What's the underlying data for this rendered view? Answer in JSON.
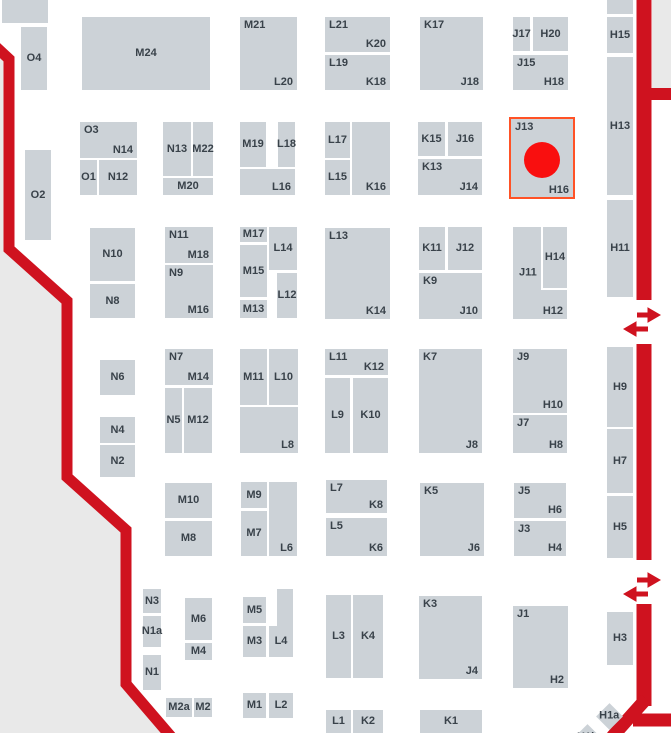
{
  "map_title": "exhibition-hall-floor-plan",
  "colors": {
    "booth_fill": "#ccd2d7",
    "outside_fill": "#e9e9e9",
    "boundary_red": "#cf121f",
    "highlight_outline": "#ff5226",
    "marker_red": "#f90f0f",
    "label_text": "#39424a",
    "background": "#ffffff"
  },
  "highlight": {
    "booth": "J13-H16",
    "frame": {
      "x": 509,
      "y": 117,
      "w": 66,
      "h": 82
    },
    "marker": {
      "cx": 542,
      "cy": 160,
      "r": 18
    }
  },
  "booths": [
    {
      "id": "block-a",
      "x": 2,
      "y": 0,
      "w": 46,
      "h": 23,
      "l": []
    },
    {
      "id": "O4",
      "x": 21,
      "y": 27,
      "w": 26,
      "h": 63,
      "l": [
        [
          "O4",
          "c"
        ]
      ]
    },
    {
      "id": "M24",
      "x": 82,
      "y": 17,
      "w": 128,
      "h": 73,
      "l": [
        [
          "M24",
          "c"
        ]
      ]
    },
    {
      "id": "M21-L20",
      "x": 240,
      "y": 17,
      "w": 57,
      "h": 73,
      "l": [
        [
          "M21",
          "tl"
        ],
        [
          "L20",
          "br"
        ]
      ]
    },
    {
      "id": "L21-K20",
      "x": 325,
      "y": 17,
      "w": 65,
      "h": 35,
      "l": [
        [
          "L21",
          "tl"
        ],
        [
          "K20",
          "br"
        ]
      ]
    },
    {
      "id": "L19-K18",
      "x": 325,
      "y": 55,
      "w": 65,
      "h": 35,
      "l": [
        [
          "L19",
          "tl"
        ],
        [
          "K18",
          "br"
        ]
      ]
    },
    {
      "id": "K17-J18",
      "x": 420,
      "y": 17,
      "w": 63,
      "h": 73,
      "l": [
        [
          "K17",
          "tl"
        ],
        [
          "J18",
          "br"
        ]
      ]
    },
    {
      "id": "J17",
      "x": 513,
      "y": 17,
      "w": 17,
      "h": 34,
      "l": [
        [
          "J17",
          "c"
        ]
      ]
    },
    {
      "id": "H20",
      "x": 533,
      "y": 17,
      "w": 35,
      "h": 34,
      "l": [
        [
          "H20",
          "c"
        ]
      ]
    },
    {
      "id": "J15-H18",
      "x": 513,
      "y": 55,
      "w": 55,
      "h": 35,
      "l": [
        [
          "J15",
          "tl"
        ],
        [
          "H18",
          "br"
        ]
      ]
    },
    {
      "id": "block-b",
      "x": 607,
      "y": 0,
      "w": 26,
      "h": 14,
      "l": []
    },
    {
      "id": "H15",
      "x": 607,
      "y": 17,
      "w": 26,
      "h": 36,
      "l": [
        [
          "H15",
          "c"
        ]
      ]
    },
    {
      "id": "H13",
      "x": 607,
      "y": 57,
      "w": 26,
      "h": 138,
      "l": [
        [
          "H13",
          "c"
        ]
      ]
    },
    {
      "id": "H11",
      "x": 607,
      "y": 200,
      "w": 26,
      "h": 97,
      "l": [
        [
          "H11",
          "c"
        ]
      ]
    },
    {
      "id": "O2",
      "x": 25,
      "y": 150,
      "w": 26,
      "h": 90,
      "l": [
        [
          "O2",
          "c"
        ]
      ]
    },
    {
      "id": "O3-N14",
      "x": 80,
      "y": 122,
      "w": 57,
      "h": 36,
      "l": [
        [
          "O3",
          "tl"
        ],
        [
          "N14",
          "br"
        ]
      ]
    },
    {
      "id": "O1",
      "x": 80,
      "y": 160,
      "w": 17,
      "h": 35,
      "l": [
        [
          "O1",
          "c"
        ]
      ]
    },
    {
      "id": "N12",
      "x": 99,
      "y": 160,
      "w": 38,
      "h": 35,
      "l": [
        [
          "N12",
          "c"
        ]
      ]
    },
    {
      "id": "N13",
      "x": 163,
      "y": 122,
      "w": 28,
      "h": 54,
      "l": [
        [
          "N13",
          "c"
        ]
      ]
    },
    {
      "id": "M22",
      "x": 193,
      "y": 122,
      "w": 20,
      "h": 54,
      "l": [
        [
          "M22",
          "c"
        ]
      ]
    },
    {
      "id": "M20",
      "x": 163,
      "y": 178,
      "w": 50,
      "h": 17,
      "l": [
        [
          "M20",
          "c"
        ]
      ]
    },
    {
      "id": "M19",
      "x": 240,
      "y": 122,
      "w": 26,
      "h": 45,
      "l": [
        [
          "M19",
          "c"
        ]
      ]
    },
    {
      "id": "L18",
      "x": 278,
      "y": 122,
      "w": 17,
      "h": 45,
      "l": [
        [
          "L18",
          "c"
        ]
      ]
    },
    {
      "id": "L16",
      "x": 240,
      "y": 169,
      "w": 55,
      "h": 26,
      "l": [
        [
          "L16",
          "br"
        ]
      ]
    },
    {
      "id": "L17",
      "x": 325,
      "y": 122,
      "w": 25,
      "h": 36,
      "l": [
        [
          "L17",
          "c"
        ]
      ]
    },
    {
      "id": "L15",
      "x": 325,
      "y": 160,
      "w": 25,
      "h": 35,
      "l": [
        [
          "L15",
          "c"
        ]
      ]
    },
    {
      "id": "K16",
      "x": 352,
      "y": 122,
      "w": 38,
      "h": 73,
      "l": [
        [
          "K16",
          "br"
        ]
      ]
    },
    {
      "id": "K15",
      "x": 418,
      "y": 122,
      "w": 27,
      "h": 34,
      "l": [
        [
          "K15",
          "c"
        ]
      ]
    },
    {
      "id": "J16",
      "x": 448,
      "y": 122,
      "w": 34,
      "h": 34,
      "l": [
        [
          "J16",
          "c"
        ]
      ]
    },
    {
      "id": "K13-J14",
      "x": 418,
      "y": 159,
      "w": 64,
      "h": 36,
      "l": [
        [
          "K13",
          "tl"
        ],
        [
          "J14",
          "br"
        ]
      ]
    },
    {
      "id": "J13-H16",
      "x": 511,
      "y": 119,
      "w": 62,
      "h": 79,
      "l": [
        [
          "J13",
          "tl"
        ],
        [
          "H16",
          "br"
        ]
      ],
      "hl": true
    },
    {
      "id": "N10",
      "x": 90,
      "y": 228,
      "w": 45,
      "h": 53,
      "l": [
        [
          "N10",
          "c"
        ]
      ]
    },
    {
      "id": "N8",
      "x": 90,
      "y": 284,
      "w": 45,
      "h": 34,
      "l": [
        [
          "N8",
          "c"
        ]
      ]
    },
    {
      "id": "N11-M18",
      "x": 165,
      "y": 227,
      "w": 48,
      "h": 36,
      "l": [
        [
          "N11",
          "tl"
        ],
        [
          "M18",
          "br"
        ]
      ]
    },
    {
      "id": "N9-M16",
      "x": 165,
      "y": 265,
      "w": 48,
      "h": 53,
      "l": [
        [
          "N9",
          "tl"
        ],
        [
          "M16",
          "br"
        ]
      ]
    },
    {
      "id": "M17",
      "x": 240,
      "y": 227,
      "w": 27,
      "h": 15,
      "l": [
        [
          "M17",
          "c"
        ]
      ]
    },
    {
      "id": "L14",
      "x": 269,
      "y": 227,
      "w": 28,
      "h": 43,
      "l": [
        [
          "L14",
          "c"
        ]
      ]
    },
    {
      "id": "M15",
      "x": 240,
      "y": 245,
      "w": 27,
      "h": 52,
      "l": [
        [
          "M15",
          "c"
        ]
      ]
    },
    {
      "id": "M13",
      "x": 240,
      "y": 300,
      "w": 27,
      "h": 18,
      "l": [
        [
          "M13",
          "c"
        ]
      ]
    },
    {
      "id": "L12",
      "x": 277,
      "y": 273,
      "w": 20,
      "h": 45,
      "l": [
        [
          "L12",
          "c"
        ]
      ]
    },
    {
      "id": "L13-K14",
      "x": 325,
      "y": 228,
      "w": 65,
      "h": 91,
      "l": [
        [
          "L13",
          "tl"
        ],
        [
          "K14",
          "br"
        ]
      ]
    },
    {
      "id": "K11",
      "x": 419,
      "y": 227,
      "w": 26,
      "h": 43,
      "l": [
        [
          "K11",
          "c"
        ]
      ]
    },
    {
      "id": "J12",
      "x": 448,
      "y": 227,
      "w": 34,
      "h": 43,
      "l": [
        [
          "J12",
          "c"
        ]
      ]
    },
    {
      "id": "K9-J10",
      "x": 419,
      "y": 273,
      "w": 63,
      "h": 46,
      "l": [
        [
          "K9",
          "tl"
        ],
        [
          "J10",
          "br"
        ]
      ]
    },
    {
      "id": "J11-H12",
      "x": 513,
      "y": 227,
      "w": 54,
      "h": 92,
      "l": [
        [
          "J11",
          "ml"
        ],
        [
          "H12",
          "br"
        ]
      ]
    },
    {
      "id": "H14",
      "x": 541,
      "y": 227,
      "w": 26,
      "h": 63,
      "l": [
        [
          "H14",
          "c"
        ]
      ],
      "wb": true
    },
    {
      "id": "N6",
      "x": 100,
      "y": 360,
      "w": 35,
      "h": 35,
      "l": [
        [
          "N6",
          "c"
        ]
      ]
    },
    {
      "id": "N4",
      "x": 100,
      "y": 417,
      "w": 35,
      "h": 26,
      "l": [
        [
          "N4",
          "c"
        ]
      ]
    },
    {
      "id": "N2",
      "x": 100,
      "y": 445,
      "w": 35,
      "h": 32,
      "l": [
        [
          "N2",
          "c"
        ]
      ]
    },
    {
      "id": "N7-M14",
      "x": 165,
      "y": 349,
      "w": 48,
      "h": 36,
      "l": [
        [
          "N7",
          "tl"
        ],
        [
          "M14",
          "br"
        ]
      ]
    },
    {
      "id": "N5",
      "x": 165,
      "y": 388,
      "w": 17,
      "h": 65,
      "l": [
        [
          "N5",
          "c"
        ]
      ]
    },
    {
      "id": "M12",
      "x": 184,
      "y": 388,
      "w": 28,
      "h": 65,
      "l": [
        [
          "M12",
          "c"
        ]
      ]
    },
    {
      "id": "M11",
      "x": 240,
      "y": 349,
      "w": 27,
      "h": 56,
      "l": [
        [
          "M11",
          "c"
        ]
      ]
    },
    {
      "id": "L10",
      "x": 269,
      "y": 349,
      "w": 29,
      "h": 56,
      "l": [
        [
          "L10",
          "c"
        ]
      ]
    },
    {
      "id": "L8",
      "x": 240,
      "y": 407,
      "w": 58,
      "h": 46,
      "l": [
        [
          "L8",
          "br"
        ]
      ]
    },
    {
      "id": "L11-K12",
      "x": 325,
      "y": 349,
      "w": 63,
      "h": 26,
      "l": [
        [
          "L11",
          "tl"
        ],
        [
          "K12",
          "br"
        ]
      ]
    },
    {
      "id": "L9",
      "x": 325,
      "y": 378,
      "w": 25,
      "h": 75,
      "l": [
        [
          "L9",
          "c"
        ]
      ]
    },
    {
      "id": "K10",
      "x": 353,
      "y": 378,
      "w": 35,
      "h": 75,
      "l": [
        [
          "K10",
          "c"
        ]
      ]
    },
    {
      "id": "K7-J8",
      "x": 419,
      "y": 349,
      "w": 63,
      "h": 104,
      "l": [
        [
          "K7",
          "tl"
        ],
        [
          "J8",
          "br"
        ]
      ]
    },
    {
      "id": "J9-H10",
      "x": 513,
      "y": 349,
      "w": 54,
      "h": 64,
      "l": [
        [
          "J9",
          "tl"
        ],
        [
          "H10",
          "br"
        ]
      ]
    },
    {
      "id": "J7-H8",
      "x": 513,
      "y": 415,
      "w": 54,
      "h": 38,
      "l": [
        [
          "J7",
          "tl"
        ],
        [
          "H8",
          "br"
        ]
      ]
    },
    {
      "id": "H9",
      "x": 607,
      "y": 347,
      "w": 26,
      "h": 80,
      "l": [
        [
          "H9",
          "c"
        ]
      ]
    },
    {
      "id": "H7",
      "x": 607,
      "y": 429,
      "w": 26,
      "h": 64,
      "l": [
        [
          "H7",
          "c"
        ]
      ]
    },
    {
      "id": "H5",
      "x": 607,
      "y": 496,
      "w": 26,
      "h": 62,
      "l": [
        [
          "H5",
          "c"
        ]
      ]
    },
    {
      "id": "M10",
      "x": 165,
      "y": 483,
      "w": 47,
      "h": 35,
      "l": [
        [
          "M10",
          "c"
        ]
      ]
    },
    {
      "id": "M8",
      "x": 165,
      "y": 521,
      "w": 47,
      "h": 35,
      "l": [
        [
          "M8",
          "c"
        ]
      ]
    },
    {
      "id": "M9",
      "x": 241,
      "y": 482,
      "w": 26,
      "h": 26,
      "l": [
        [
          "M9",
          "c"
        ]
      ]
    },
    {
      "id": "M7",
      "x": 241,
      "y": 511,
      "w": 26,
      "h": 45,
      "l": [
        [
          "M7",
          "c"
        ]
      ]
    },
    {
      "id": "L6",
      "x": 269,
      "y": 482,
      "w": 28,
      "h": 74,
      "l": [
        [
          "L6",
          "br"
        ]
      ]
    },
    {
      "id": "L7-K8",
      "x": 326,
      "y": 480,
      "w": 61,
      "h": 33,
      "l": [
        [
          "L7",
          "tl"
        ],
        [
          "K8",
          "br"
        ]
      ]
    },
    {
      "id": "L5-K6",
      "x": 326,
      "y": 518,
      "w": 61,
      "h": 38,
      "l": [
        [
          "L5",
          "tl"
        ],
        [
          "K6",
          "br"
        ]
      ]
    },
    {
      "id": "K5-J6",
      "x": 420,
      "y": 483,
      "w": 64,
      "h": 73,
      "l": [
        [
          "K5",
          "tl"
        ],
        [
          "J6",
          "br"
        ]
      ]
    },
    {
      "id": "J5-H6",
      "x": 514,
      "y": 483,
      "w": 52,
      "h": 35,
      "l": [
        [
          "J5",
          "tl"
        ],
        [
          "H6",
          "br"
        ]
      ]
    },
    {
      "id": "J3-H4",
      "x": 514,
      "y": 521,
      "w": 52,
      "h": 35,
      "l": [
        [
          "J3",
          "tl"
        ],
        [
          "H4",
          "br"
        ]
      ]
    },
    {
      "id": "N3",
      "x": 143,
      "y": 589,
      "w": 18,
      "h": 24,
      "l": [
        [
          "N3",
          "c"
        ]
      ]
    },
    {
      "id": "N1a",
      "x": 143,
      "y": 616,
      "w": 18,
      "h": 31,
      "l": [
        [
          "N1a",
          "c"
        ]
      ]
    },
    {
      "id": "N1",
      "x": 143,
      "y": 655,
      "w": 18,
      "h": 35,
      "l": [
        [
          "N1",
          "c"
        ]
      ]
    },
    {
      "id": "M6",
      "x": 185,
      "y": 598,
      "w": 27,
      "h": 42,
      "l": [
        [
          "M6",
          "c"
        ]
      ]
    },
    {
      "id": "M4",
      "x": 185,
      "y": 643,
      "w": 27,
      "h": 17,
      "l": [
        [
          "M4",
          "c"
        ]
      ]
    },
    {
      "id": "M5",
      "x": 243,
      "y": 597,
      "w": 23,
      "h": 26,
      "l": [
        [
          "M5",
          "c"
        ]
      ]
    },
    {
      "id": "M3",
      "x": 243,
      "y": 626,
      "w": 23,
      "h": 31,
      "l": [
        [
          "M3",
          "c"
        ]
      ]
    },
    {
      "id": "L4-upper",
      "x": 277,
      "y": 589,
      "w": 16,
      "h": 37,
      "l": []
    },
    {
      "id": "L4",
      "x": 269,
      "y": 626,
      "w": 24,
      "h": 31,
      "l": [
        [
          "L4",
          "c"
        ]
      ]
    },
    {
      "id": "L3",
      "x": 326,
      "y": 595,
      "w": 25,
      "h": 83,
      "l": [
        [
          "L3",
          "c"
        ]
      ]
    },
    {
      "id": "K4",
      "x": 353,
      "y": 595,
      "w": 30,
      "h": 83,
      "l": [
        [
          "K4",
          "c"
        ]
      ]
    },
    {
      "id": "K3-J4",
      "x": 419,
      "y": 596,
      "w": 63,
      "h": 83,
      "l": [
        [
          "K3",
          "tl"
        ],
        [
          "J4",
          "br"
        ]
      ]
    },
    {
      "id": "J1-H2",
      "x": 513,
      "y": 606,
      "w": 55,
      "h": 82,
      "l": [
        [
          "J1",
          "tl"
        ],
        [
          "H2",
          "br"
        ]
      ]
    },
    {
      "id": "H3",
      "x": 607,
      "y": 612,
      "w": 26,
      "h": 53,
      "l": [
        [
          "H3",
          "c"
        ]
      ]
    },
    {
      "id": "M2a",
      "x": 166,
      "y": 698,
      "w": 26,
      "h": 19,
      "l": [
        [
          "M2a",
          "c"
        ]
      ]
    },
    {
      "id": "M2",
      "x": 194,
      "y": 698,
      "w": 18,
      "h": 19,
      "l": [
        [
          "M2",
          "c"
        ]
      ]
    },
    {
      "id": "M1",
      "x": 243,
      "y": 693,
      "w": 23,
      "h": 25,
      "l": [
        [
          "M1",
          "c"
        ]
      ]
    },
    {
      "id": "L2",
      "x": 269,
      "y": 693,
      "w": 24,
      "h": 25,
      "l": [
        [
          "L2",
          "c"
        ]
      ]
    },
    {
      "id": "L1",
      "x": 326,
      "y": 710,
      "w": 25,
      "h": 23,
      "l": [
        [
          "L1",
          "c"
        ]
      ]
    },
    {
      "id": "K2",
      "x": 353,
      "y": 710,
      "w": 30,
      "h": 23,
      "l": [
        [
          "K2",
          "c"
        ]
      ]
    },
    {
      "id": "K1",
      "x": 420,
      "y": 710,
      "w": 62,
      "h": 23,
      "l": [
        [
          "K1",
          "c"
        ]
      ]
    }
  ],
  "diamond_booths": [
    {
      "id": "H1a",
      "t": "H1a",
      "cx": 609,
      "cy": 716,
      "s": 19
    },
    {
      "id": "H1b",
      "t": "H1b",
      "cx": 587,
      "cy": 737,
      "s": 19
    }
  ],
  "crossing_arrow_icons": [
    {
      "x": 644,
      "y": 315
    },
    {
      "x": 644,
      "y": 580
    }
  ]
}
